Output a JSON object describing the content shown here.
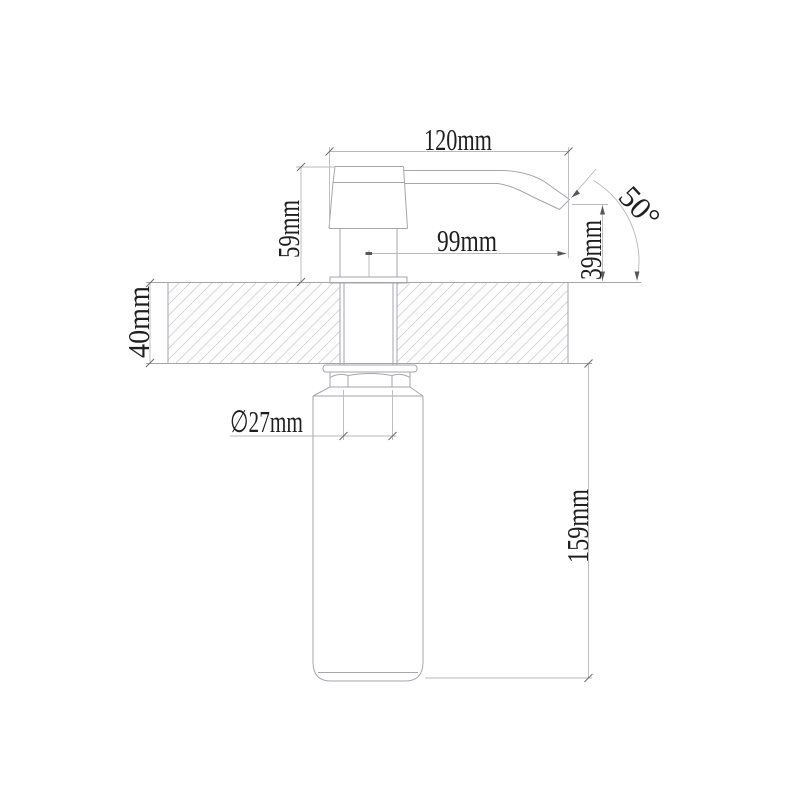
{
  "drawing": {
    "title": "soap dispenser installation dimension drawing",
    "colors": {
      "background": "#ffffff",
      "line_color": "#a5a5ad",
      "dim_line_color": "#b8b8be",
      "hatch_color": "#cfcfd5",
      "text_color": "#1f1f1f"
    },
    "labels": {
      "top_width": "120mm",
      "head_height": "59mm",
      "spout_reach": "99mm",
      "spout_height": "39mm",
      "spout_angle": "50°",
      "deck_thickness": "40mm",
      "shank_diameter": "∅27mm",
      "bottle_length": "159mm"
    },
    "values_mm": {
      "top_width": 120,
      "head_height": 59,
      "spout_reach": 99,
      "spout_height": 39,
      "deck_thickness": 40,
      "shank_diameter": 27,
      "bottle_length": 159
    },
    "spout_angle_deg": 50
  }
}
